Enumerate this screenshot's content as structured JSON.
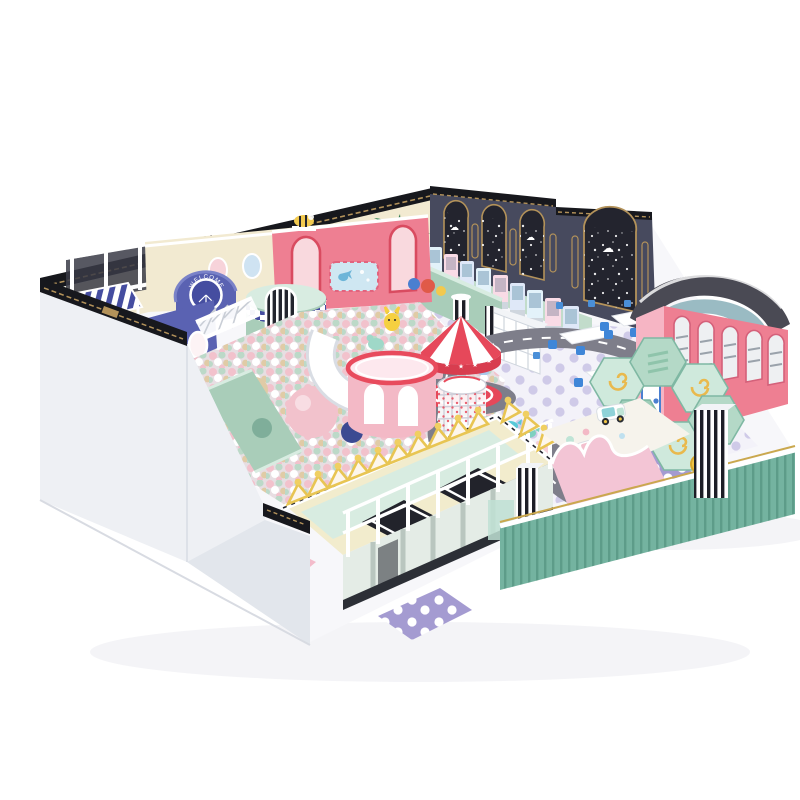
{
  "scene": {
    "type": "3d product render",
    "subject": "kids indoor soft play playground on white background",
    "background": "#ffffff"
  },
  "labels": {
    "welcome_badge": "WELCOME"
  },
  "icons": {
    "star": "★",
    "cloud": "☁"
  },
  "equipment": [
    "navy-back-wall-with-gold-arches",
    "claw-machine-row",
    "welcome-arch",
    "striped-awning-structure",
    "purple-tower",
    "teal-round-tower",
    "rope-bridge",
    "ball-pit",
    "pink-cylinder-tower",
    "spiral-slide-cage",
    "carousel",
    "crown-fence",
    "trampoline-deck",
    "road-track",
    "ride-on-cars",
    "tables-and-chairs",
    "hexagon-climber",
    "pink-bus-structure",
    "sand-play-area",
    "mint-slat-fence",
    "white-outer-wall",
    "palm-tree"
  ],
  "colors": {
    "bg": "#ffffff",
    "navy_wall": "#474a5e",
    "navy_deep": "#23242e",
    "black_trim": "#17181d",
    "gold": "#b3925a",
    "cream": "#f2ead1",
    "white_wall": "#eef0f4",
    "white_wall_shade": "#e2e6ec",
    "purple_blue": "#5a62b2",
    "purple_deep": "#454da0",
    "stripe_blue": "#4d57a8",
    "pink_soft": "#f3b9c6",
    "pink_hot": "#ee7f92",
    "red": "#e6485a",
    "mint": "#a9cdb9",
    "mint_deep": "#74b3a0",
    "mint_pale": "#d8ece1",
    "lavender": "#a49bd1",
    "lavender_pale": "#cfcae8",
    "road": "#7e7e8a",
    "yellow": "#f0cf62",
    "table_blue": "#3f86d8",
    "sand": "#f6f3ec",
    "roof_gray": "#4a4a54",
    "ball_pink": "#f2c2cc",
    "ball_mint": "#bcd9c8",
    "ball_beige": "#e0cba6"
  }
}
